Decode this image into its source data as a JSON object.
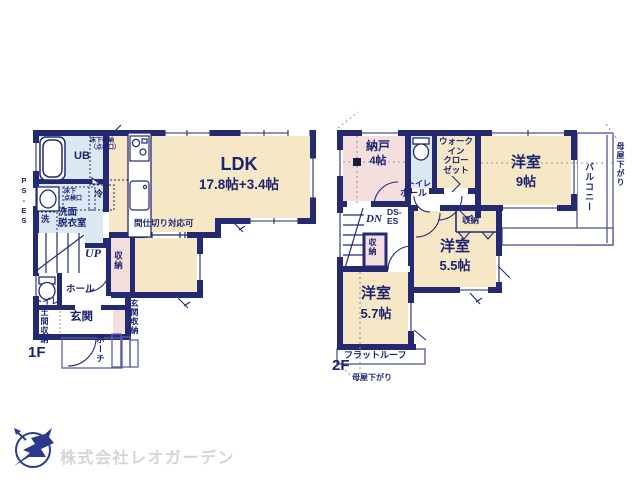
{
  "colors": {
    "wall": "#232a72",
    "room_cream": "#f6e7c6",
    "room_pink": "#f5dede",
    "room_blue": "#dce9f3",
    "logo_navy": "#2a3b8f",
    "logo_text_gray": "#d5d5d5"
  },
  "floor1": {
    "label": "1F",
    "ldk": "LDK",
    "ldk_size": "17.8帖+3.4帖",
    "partition_note": "間仕切り対応可",
    "unit_bath": "UB",
    "washroom": "洗面\n脱衣室",
    "washer": "洗",
    "fridge": "冷",
    "underfloor_storage": "床下収納\n（点検口）",
    "underfloor_hatch": "床下\n点検口",
    "up": "UP",
    "storage": "収納",
    "toilet": "トイレ",
    "hall": "ホール",
    "entrance": "玄関",
    "doma_storage": "土間収納",
    "entrance_storage": "玄関収納",
    "porch": "ポーチ",
    "pipe_space": "PS-ES"
  },
  "floor2": {
    "label": "2F",
    "storeroom": "納戸",
    "storeroom_size": "4帖",
    "toilet": "トイレ",
    "walk_in_closet": "ウォーク\nイン\nクロー\nゼット",
    "room9": "洋室",
    "room9_size": "9帖",
    "balcony": "バルコニー",
    "eave_right": "母屋下がり",
    "eave_bottom": "母屋下がり",
    "hall": "ホール",
    "down": "DN",
    "duct_space": "DS-\nES",
    "stair_closet": "収納",
    "room55_closet": "収納",
    "room55": "洋室",
    "room55_size": "5.5帖",
    "room57": "洋室",
    "room57_size": "5.7帖",
    "flat_roof": "フラットルーフ"
  },
  "logo": {
    "company": "株式会社レオガーデン"
  }
}
